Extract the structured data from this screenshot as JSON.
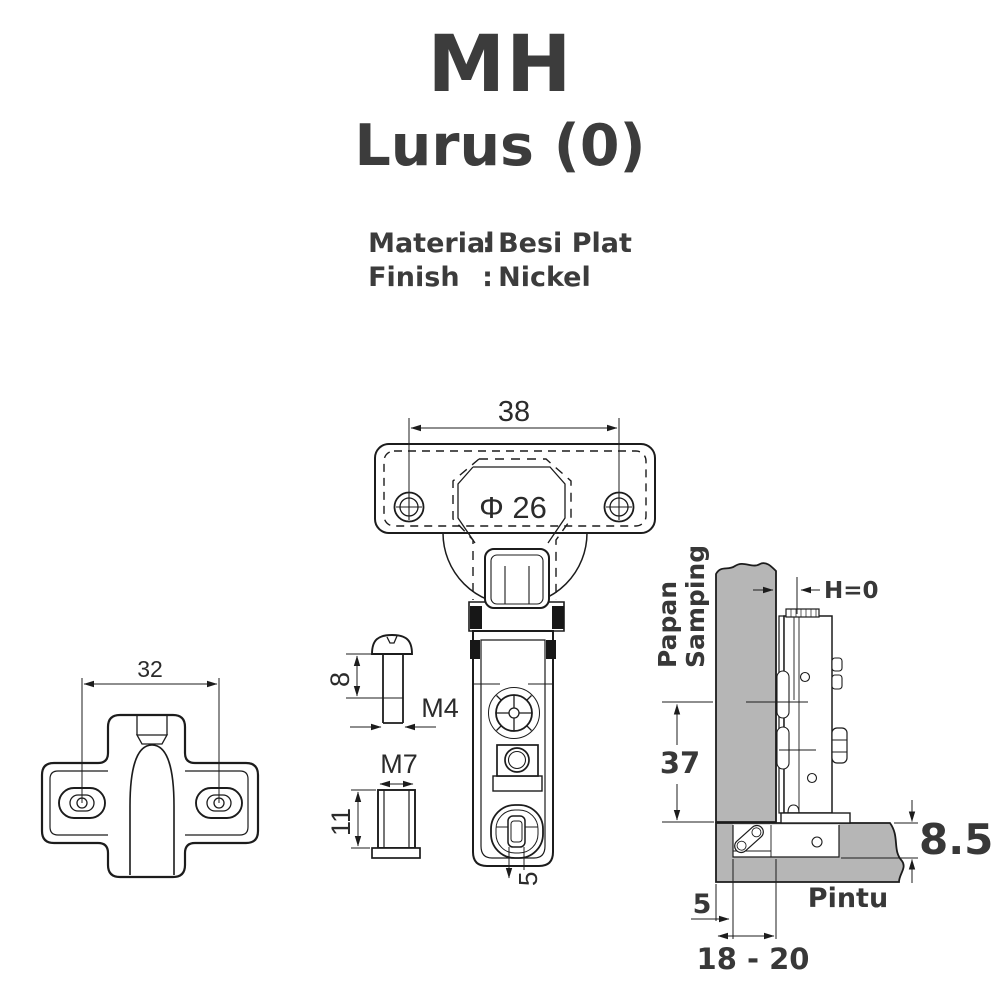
{
  "header": {
    "title": "MH",
    "subtitle": "Lurus (0)",
    "specs": [
      {
        "label": "Material",
        "separator": ":",
        "value": "Besi Plat"
      },
      {
        "label": "Finish",
        "separator": ":",
        "value": "Nickel"
      }
    ]
  },
  "top_view": {
    "mounting_hole_spacing": "38",
    "cup_diameter": "Φ 26"
  },
  "arm_view": {
    "slot_adjustment": "5"
  },
  "screw_detail": {
    "thread_length": "8",
    "thread_size": "M4"
  },
  "dowel_detail": {
    "thread_size": "M7",
    "body_length": "11"
  },
  "mounting_plate_view": {
    "hole_spacing": "32"
  },
  "installation_view": {
    "side_panel_label_line1": "Papan",
    "side_panel_label_line2": "Samping",
    "overlay": "H=0",
    "plate_line_distance": "37",
    "cup_depth": "8.5",
    "cup_edge_distance": "5",
    "bore_distance": "18 - 20",
    "door_label": "Pintu"
  },
  "colors": {
    "ink": "#3a3a3a",
    "line": "#1c1c1c",
    "panel_fill": "#b6b6b6",
    "background": "#ffffff"
  }
}
